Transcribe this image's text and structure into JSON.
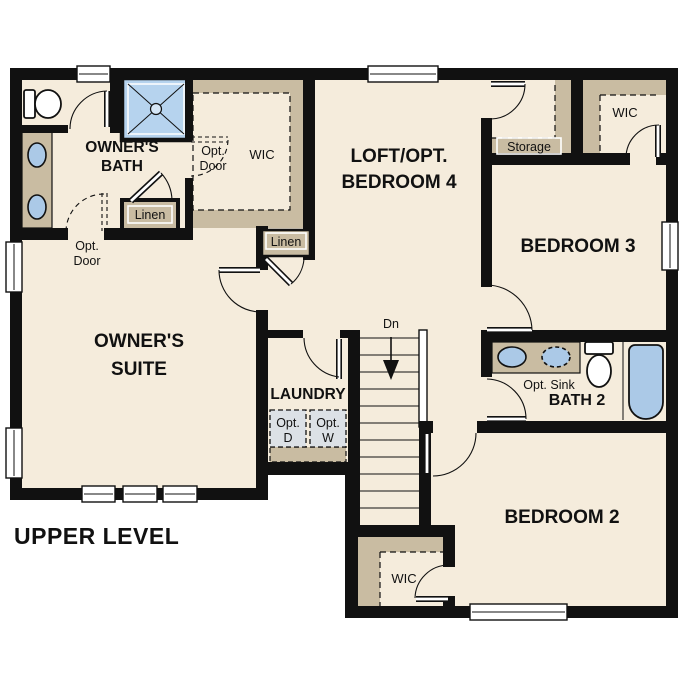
{
  "title": "UPPER LEVEL",
  "labels": {
    "upper_level": "UPPER LEVEL",
    "owners_bath": {
      "l1": "OWNER'S",
      "l2": "BATH"
    },
    "owners_suite": {
      "l1": "OWNER'S",
      "l2": "SUITE"
    },
    "loft": {
      "l1": "LOFT/OPT.",
      "l2": "BEDROOM 4"
    },
    "bedroom3": "BEDROOM 3",
    "bedroom2": "BEDROOM 2",
    "bath2": "BATH 2",
    "laundry": "LAUNDRY",
    "wic_owners": "WIC",
    "wic_bedroom3": "WIC",
    "wic_bedroom2": "WIC",
    "linen_bath": "Linen",
    "linen_hall": "Linen",
    "storage": "Storage",
    "opt_door_wic": {
      "l1": "Opt.",
      "l2": "Door"
    },
    "opt_door_suite": {
      "l1": "Opt.",
      "l2": "Door"
    },
    "opt_sink": "Opt. Sink",
    "opt_dryer": {
      "l1": "Opt.",
      "l2": "D"
    },
    "opt_washer": {
      "l1": "Opt.",
      "l2": "W"
    },
    "stairs_down": "Dn"
  },
  "colors": {
    "wall": "#111111",
    "floor": "#f5ecdc",
    "tan": "#c9bca2",
    "blue": "#abc9e7",
    "shower": "#b6d3ee",
    "appl": "#dce1e6",
    "bg": "#ffffff",
    "txt": "#111111"
  }
}
